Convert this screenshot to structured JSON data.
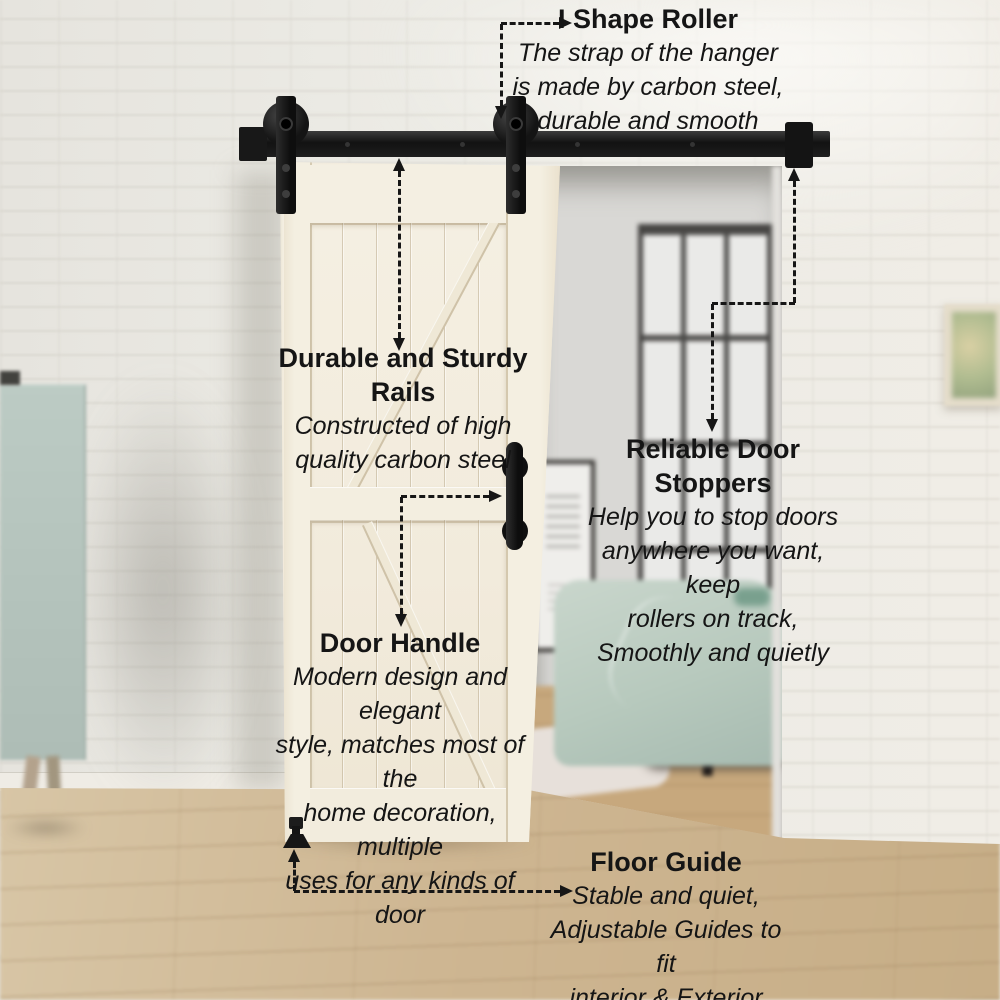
{
  "annotations": {
    "roller": {
      "title": "I Shape Roller",
      "lines": [
        "The strap of the hanger",
        "is made by carbon steel,",
        "durable and smooth"
      ]
    },
    "rails": {
      "title": "Durable and Sturdy Rails",
      "lines": [
        "Constructed of high",
        "quality carbon steel"
      ]
    },
    "stoppers": {
      "title": "Reliable Door Stoppers",
      "lines": [
        "Help you to stop doors",
        "anywhere you want, keep",
        "rollers on track,",
        "Smoothly and quietly"
      ]
    },
    "handle": {
      "title": "Door Handle",
      "lines": [
        "Modern design and elegant",
        "style, matches most of the",
        "home decoration, multiple",
        "uses for any kinds of door"
      ]
    },
    "floor_guide": {
      "title": "Floor Guide",
      "lines": [
        "Stable and quiet,",
        "Adjustable Guides to fit",
        "interior & Exterior Doors"
      ]
    }
  },
  "colors": {
    "annotation_text": "#151515",
    "hardware_black": "#161616",
    "door_cream": "#f3eddf",
    "cabinet_sage": "#b7c6bf",
    "bedding_mint": "#bccdc2",
    "floor_wood": "#ccb591",
    "wall_white": "#ebe9e3"
  }
}
